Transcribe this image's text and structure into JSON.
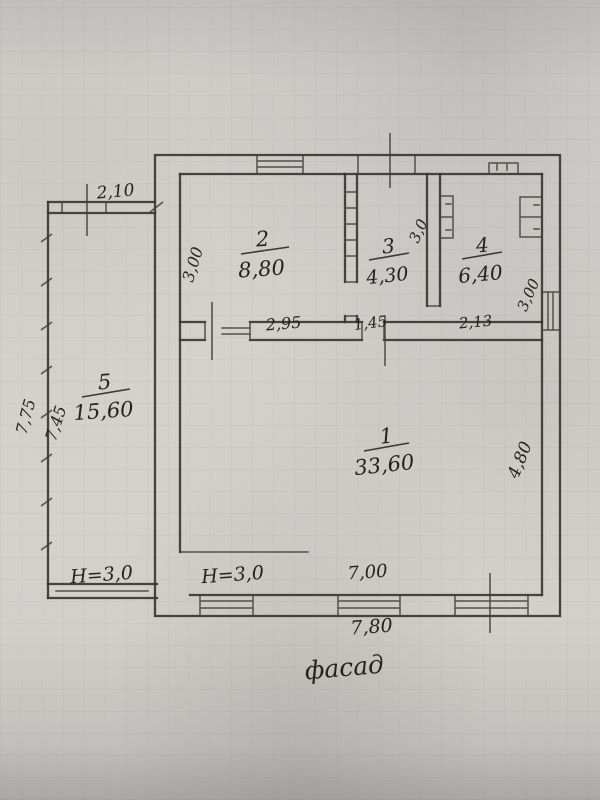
{
  "plan": {
    "caption": "фасад",
    "rooms": [
      {
        "number": "1",
        "area": "33,60",
        "depth": "4,80",
        "height": "H=3,0"
      },
      {
        "number": "2",
        "area": "8,80",
        "depth": "3,00",
        "width": "2,95"
      },
      {
        "number": "3",
        "area": "4,30",
        "depth": "3,0",
        "width": "1,45"
      },
      {
        "number": "4",
        "area": "6,40",
        "depth": "3,00",
        "width": "2,13"
      },
      {
        "number": "5",
        "area": "15,60",
        "height": "H=3,0"
      }
    ],
    "annex": {
      "width_top": "2,10",
      "height_outer": "7,75",
      "height_inner": "7,45"
    },
    "facade": {
      "width_inner": "7,00",
      "width_outer": "7,80"
    }
  }
}
